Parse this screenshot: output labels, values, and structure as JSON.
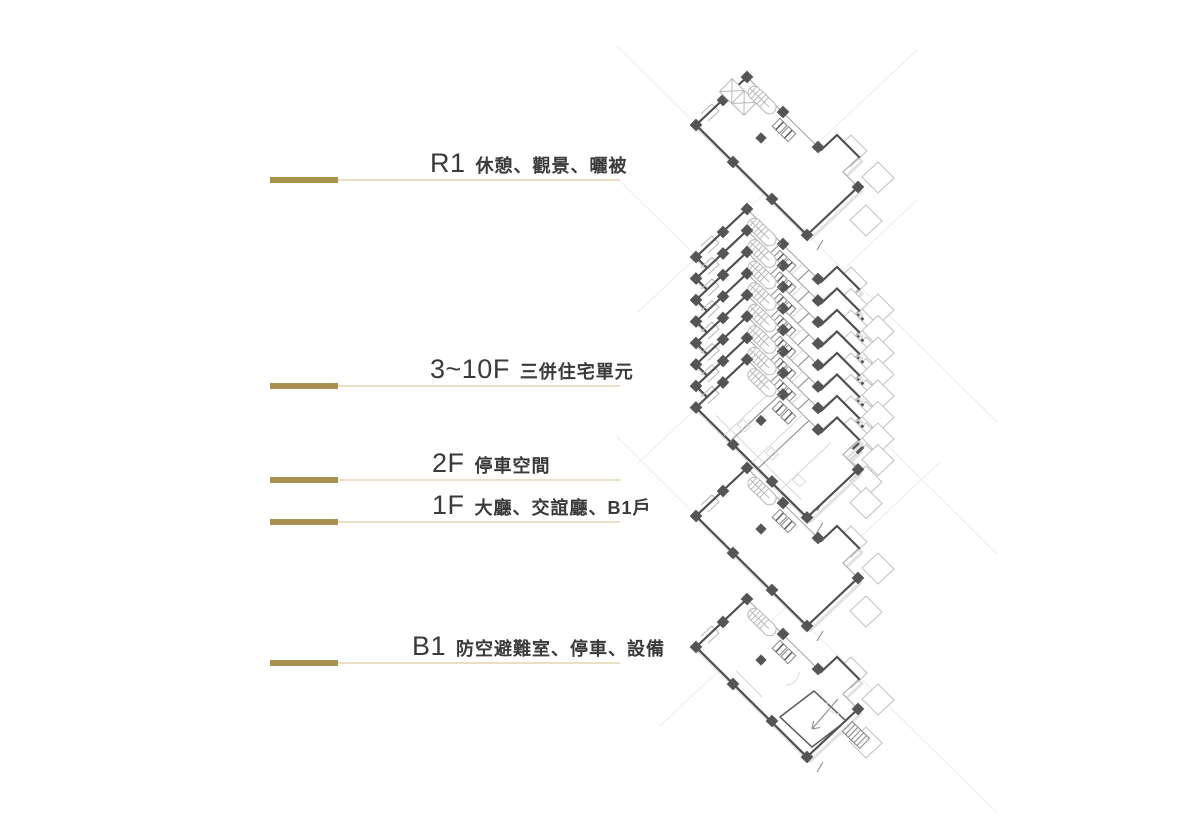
{
  "labels": [
    {
      "code": "R1",
      "desc": "休憩、觀景、曬被"
    },
    {
      "code": "3~10F",
      "desc": "三併住宅單元"
    },
    {
      "code": "2F",
      "desc": "停車空間"
    },
    {
      "code": "1F",
      "desc": "大廳、交誼廳、B1戶"
    },
    {
      "code": "B1",
      "desc": "防空避難室、停車、設備"
    }
  ],
  "colors": {
    "gold": "#a6914e",
    "tan": "#e8dfc5",
    "ink": "#3a3a3a"
  },
  "drawing": {
    "x": 696,
    "floors": [
      {
        "kind": "roof",
        "name": "R1",
        "y": 125
      },
      {
        "kind": "unit",
        "name": "10F",
        "y": 257
      },
      {
        "kind": "unit",
        "name": "9F",
        "y": 278.5
      },
      {
        "kind": "unit",
        "name": "8F",
        "y": 300
      },
      {
        "kind": "unit",
        "name": "7F",
        "y": 321.5
      },
      {
        "kind": "unit",
        "name": "6F",
        "y": 343
      },
      {
        "kind": "unit",
        "name": "5F",
        "y": 364.5
      },
      {
        "kind": "unit",
        "name": "4F",
        "y": 386
      },
      {
        "kind": "unit",
        "name": "3F",
        "y": 407.5
      },
      {
        "kind": "empty",
        "name": "2F",
        "y": 516
      },
      {
        "kind": "bottom",
        "name": "1F-B1",
        "y": 647
      }
    ]
  }
}
